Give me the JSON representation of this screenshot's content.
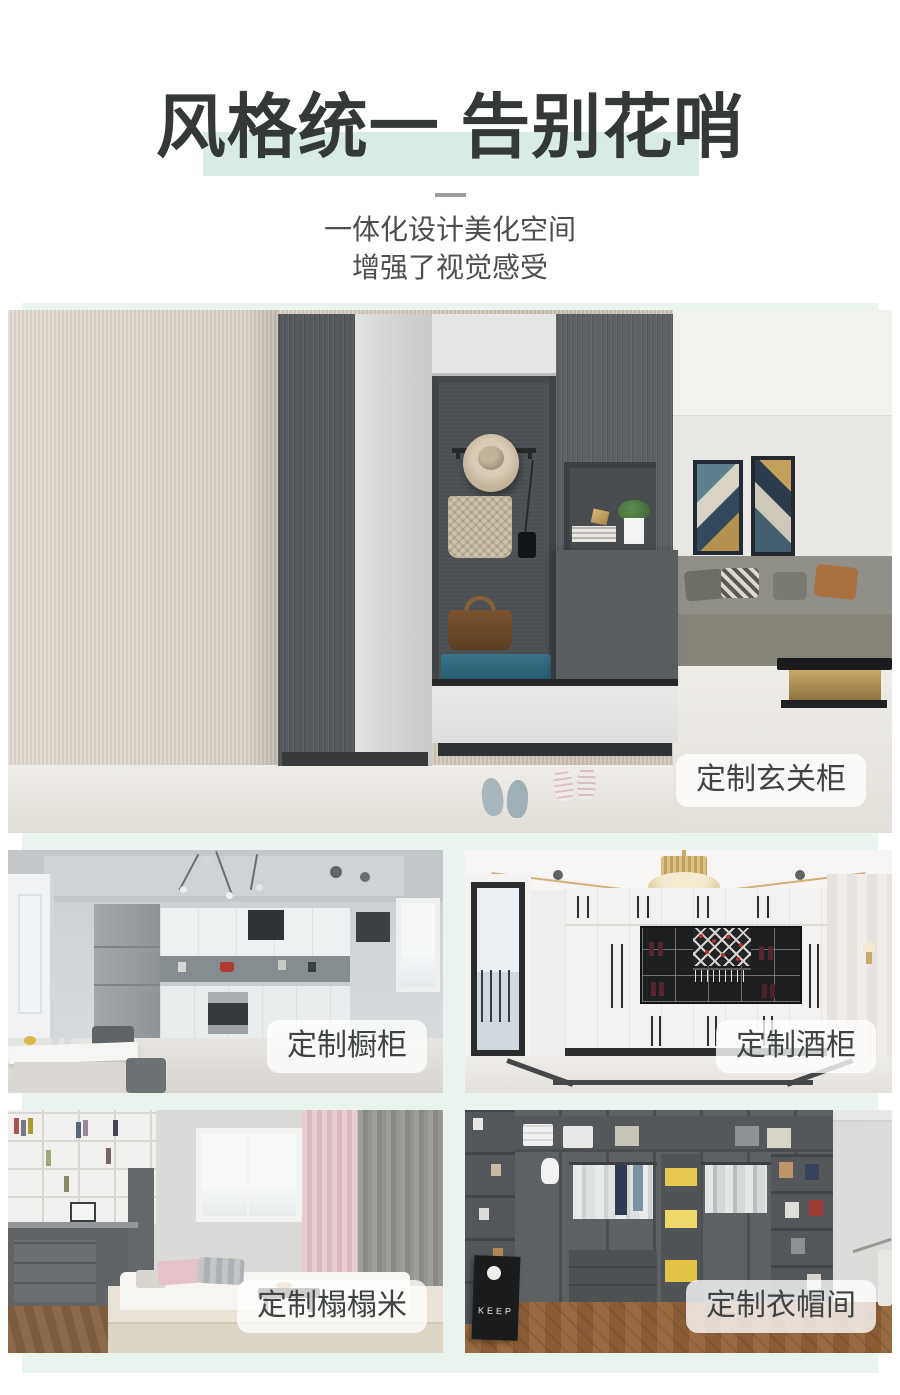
{
  "header": {
    "title": "风格统一 告别花哨",
    "subtitle_lines": [
      "一体化设计美化空间",
      "增强了视觉感受"
    ]
  },
  "colors": {
    "accent_mint": "#d8ece5",
    "panel_mint": "#e9f4ef",
    "title_text": "#343837",
    "subtitle_text": "#4c4f4e",
    "label_text": "#3f4443",
    "label_bg": "rgba(255,255,255,0.78)"
  },
  "showcase": {
    "hero": {
      "label": "定制玄关柜"
    },
    "tiles": [
      {
        "id": "kitchen",
        "label": "定制橱柜"
      },
      {
        "id": "wine-cabinet",
        "label": "定制酒柜"
      },
      {
        "id": "tatami",
        "label": "定制榻榻米"
      },
      {
        "id": "cloakroom",
        "label": "定制衣帽间"
      }
    ]
  },
  "decor": {
    "poster_text": "KEEP"
  }
}
